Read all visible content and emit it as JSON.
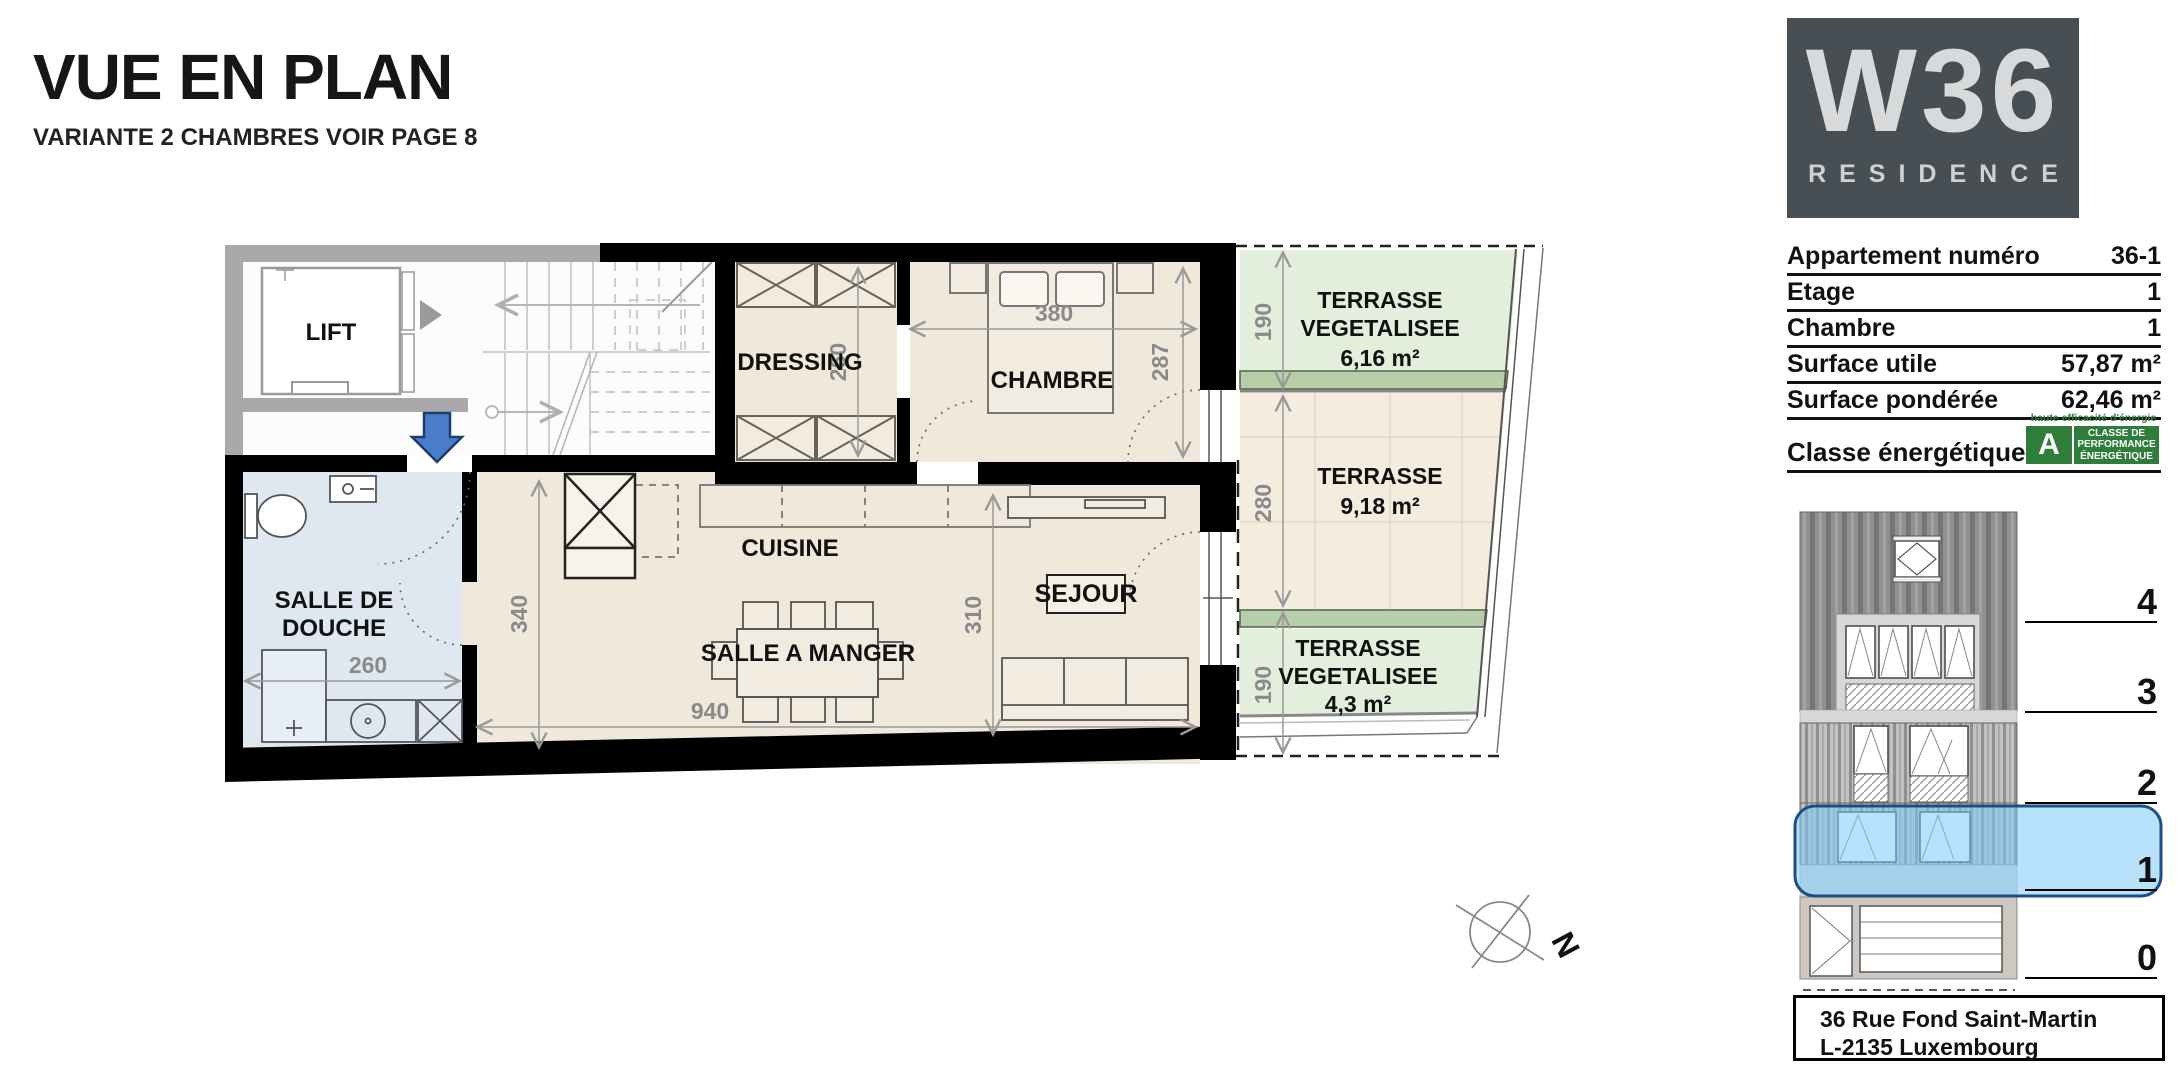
{
  "header": {
    "title": "VUE EN PLAN",
    "subtitle": "VARIANTE 2 CHAMBRES VOIR PAGE 8"
  },
  "logo": {
    "main": "W36",
    "sub": "RESIDENCE"
  },
  "info": {
    "rows": [
      {
        "label": "Appartement numéro",
        "value": "36-1"
      },
      {
        "label": "Etage",
        "value": "1"
      },
      {
        "label": "Chambre",
        "value": "1"
      },
      {
        "label": "Surface utile",
        "value": "57,87 m²"
      },
      {
        "label": "Surface pondérée",
        "value": "62,46 m²"
      }
    ]
  },
  "energy": {
    "label": "Classe énergétique",
    "tagline": "haute efficacité d'énergie",
    "grade": "A",
    "badge": "CLASSE DE PERFORMANCE ÉNERGÉTIQUE"
  },
  "elevation": {
    "floors": [
      "4",
      "3",
      "2",
      "1",
      "0"
    ]
  },
  "address": {
    "line1": "36 Rue Fond Saint-Martin",
    "line2": "L-2135 Luxembourg"
  },
  "plan": {
    "rooms": {
      "lift": "LIFT",
      "dressing": "DRESSING",
      "chambre": "CHAMBRE",
      "cuisine": "CUISINE",
      "salle_a_manger": "SALLE A MANGER",
      "sejour": "SEJOUR",
      "douche1": "SALLE DE",
      "douche2": "DOUCHE"
    },
    "terraces": {
      "top": {
        "l1": "TERRASSE",
        "l2": "VEGETALISEE",
        "area": "6,16 m²"
      },
      "mid": {
        "l1": "TERRASSE",
        "area": "9,18 m²"
      },
      "bot": {
        "l1": "TERRASSE",
        "l2": "VEGETALISEE",
        "area": "4,3 m²"
      }
    },
    "dims": {
      "chambre_w": "380",
      "chambre_h": "287",
      "dressing_h": "260",
      "douche_w": "260",
      "living_h": "340",
      "living_w": "940",
      "sejour_h": "310",
      "t_top": "190",
      "t_mid": "280",
      "t_bot": "190"
    },
    "compass": "N"
  },
  "colors": {
    "accent_blue": "#4a7dc9",
    "accent_blue_border": "#1c3f6e",
    "highlight_fill": "#7dcaf7",
    "highlight_border": "#1d4f82",
    "energy_green": "#2e7d3b",
    "terrace_green": "#e4eedd",
    "terrace_band_green": "#b6cfa8",
    "logo_slate": "#474f54"
  }
}
